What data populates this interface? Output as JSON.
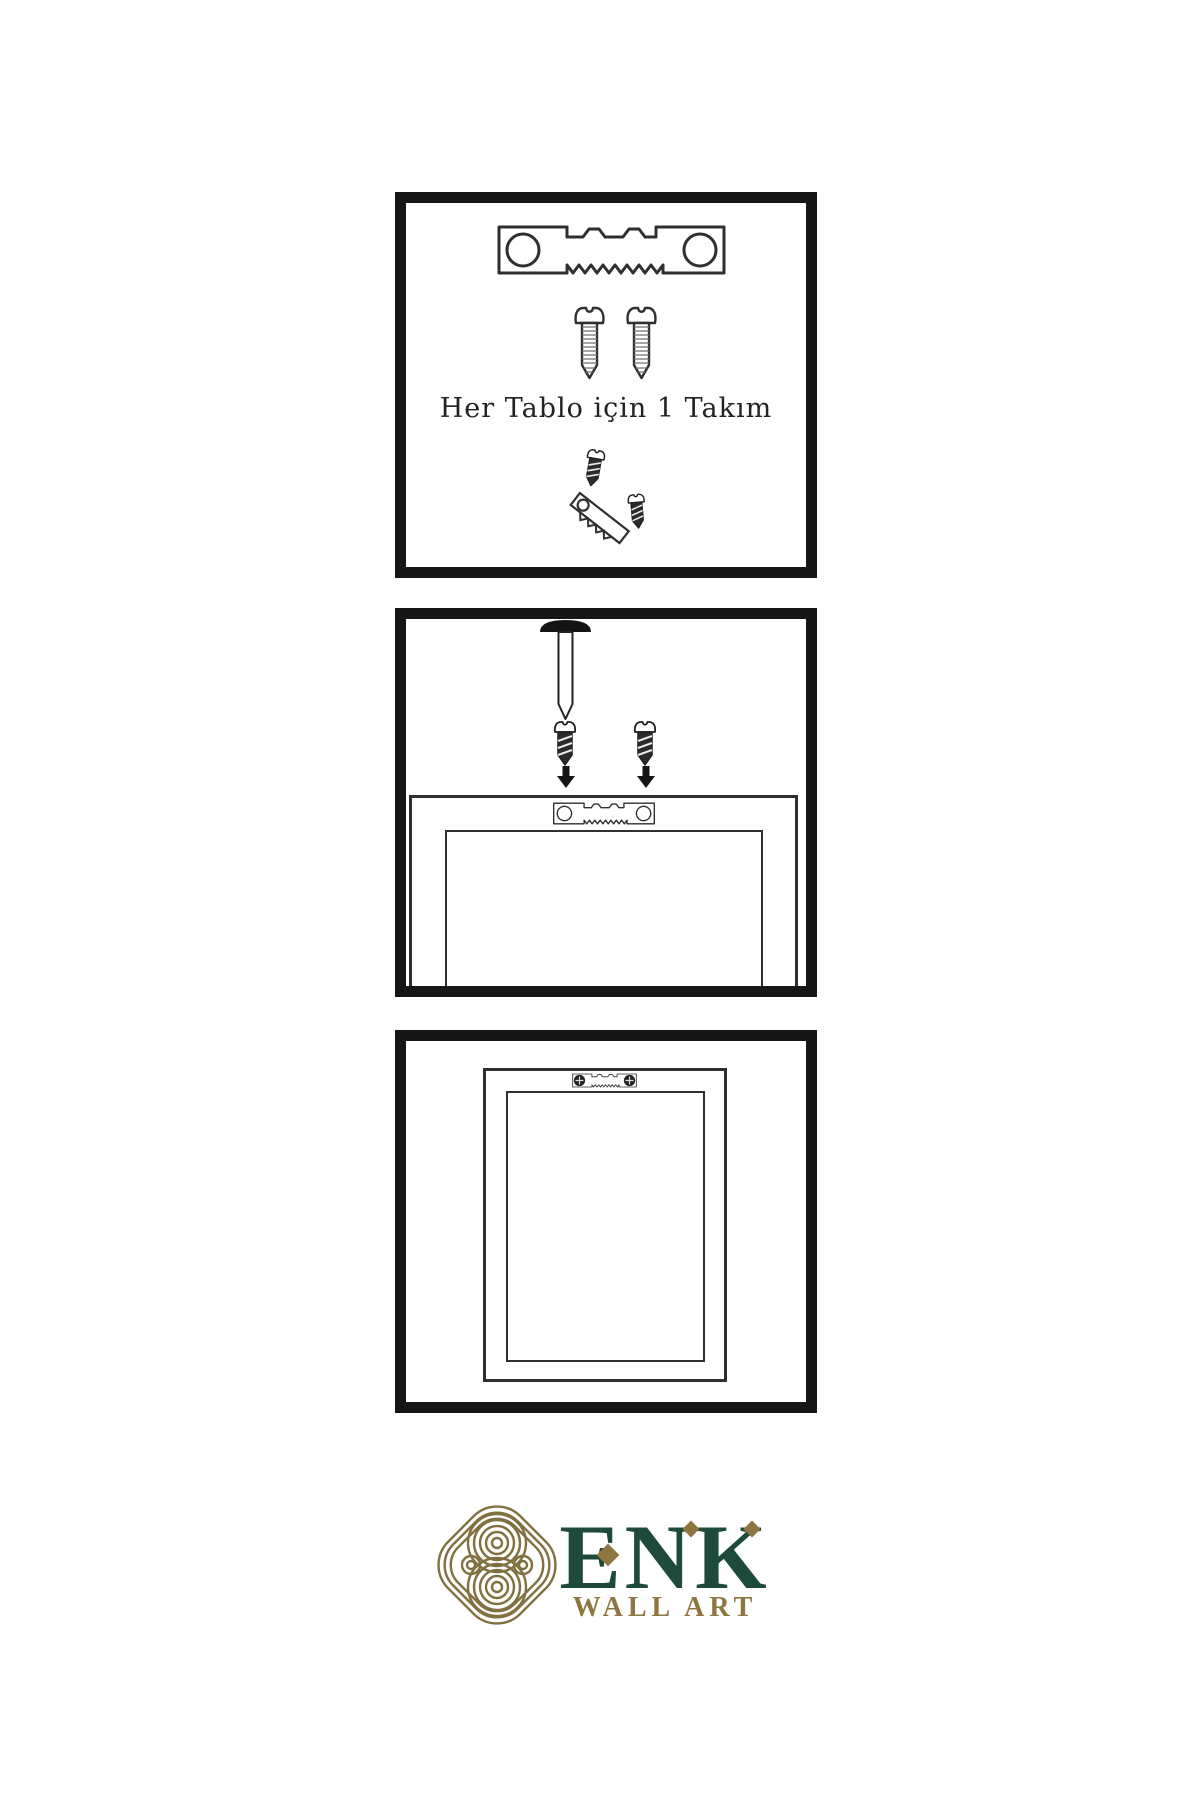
{
  "theme": {
    "bg": "#ffffff",
    "ink": "#161616",
    "line": "#2f2f2f",
    "brand_green": "#1d4a39",
    "brand_gold": "#8e7641",
    "knot_gold": "#817040",
    "caption_color": "#222222"
  },
  "panels": {
    "kit": {
      "caption": "Her Tablo için 1 Takım",
      "icons": [
        "sawtooth-hanger-icon",
        "screw-icon",
        "screw-icon",
        "screw-into-hanger-icon"
      ]
    },
    "mount": {
      "icons": [
        "wall-nail-icon",
        "screw-icon",
        "screw-icon",
        "arrow-down-icon",
        "frame-back-with-hanger-icon"
      ]
    },
    "result": {
      "icons": [
        "hung-frame-with-hanger-icon"
      ]
    }
  },
  "logo": {
    "brand": "ENK",
    "tagline": "WALL ART"
  }
}
